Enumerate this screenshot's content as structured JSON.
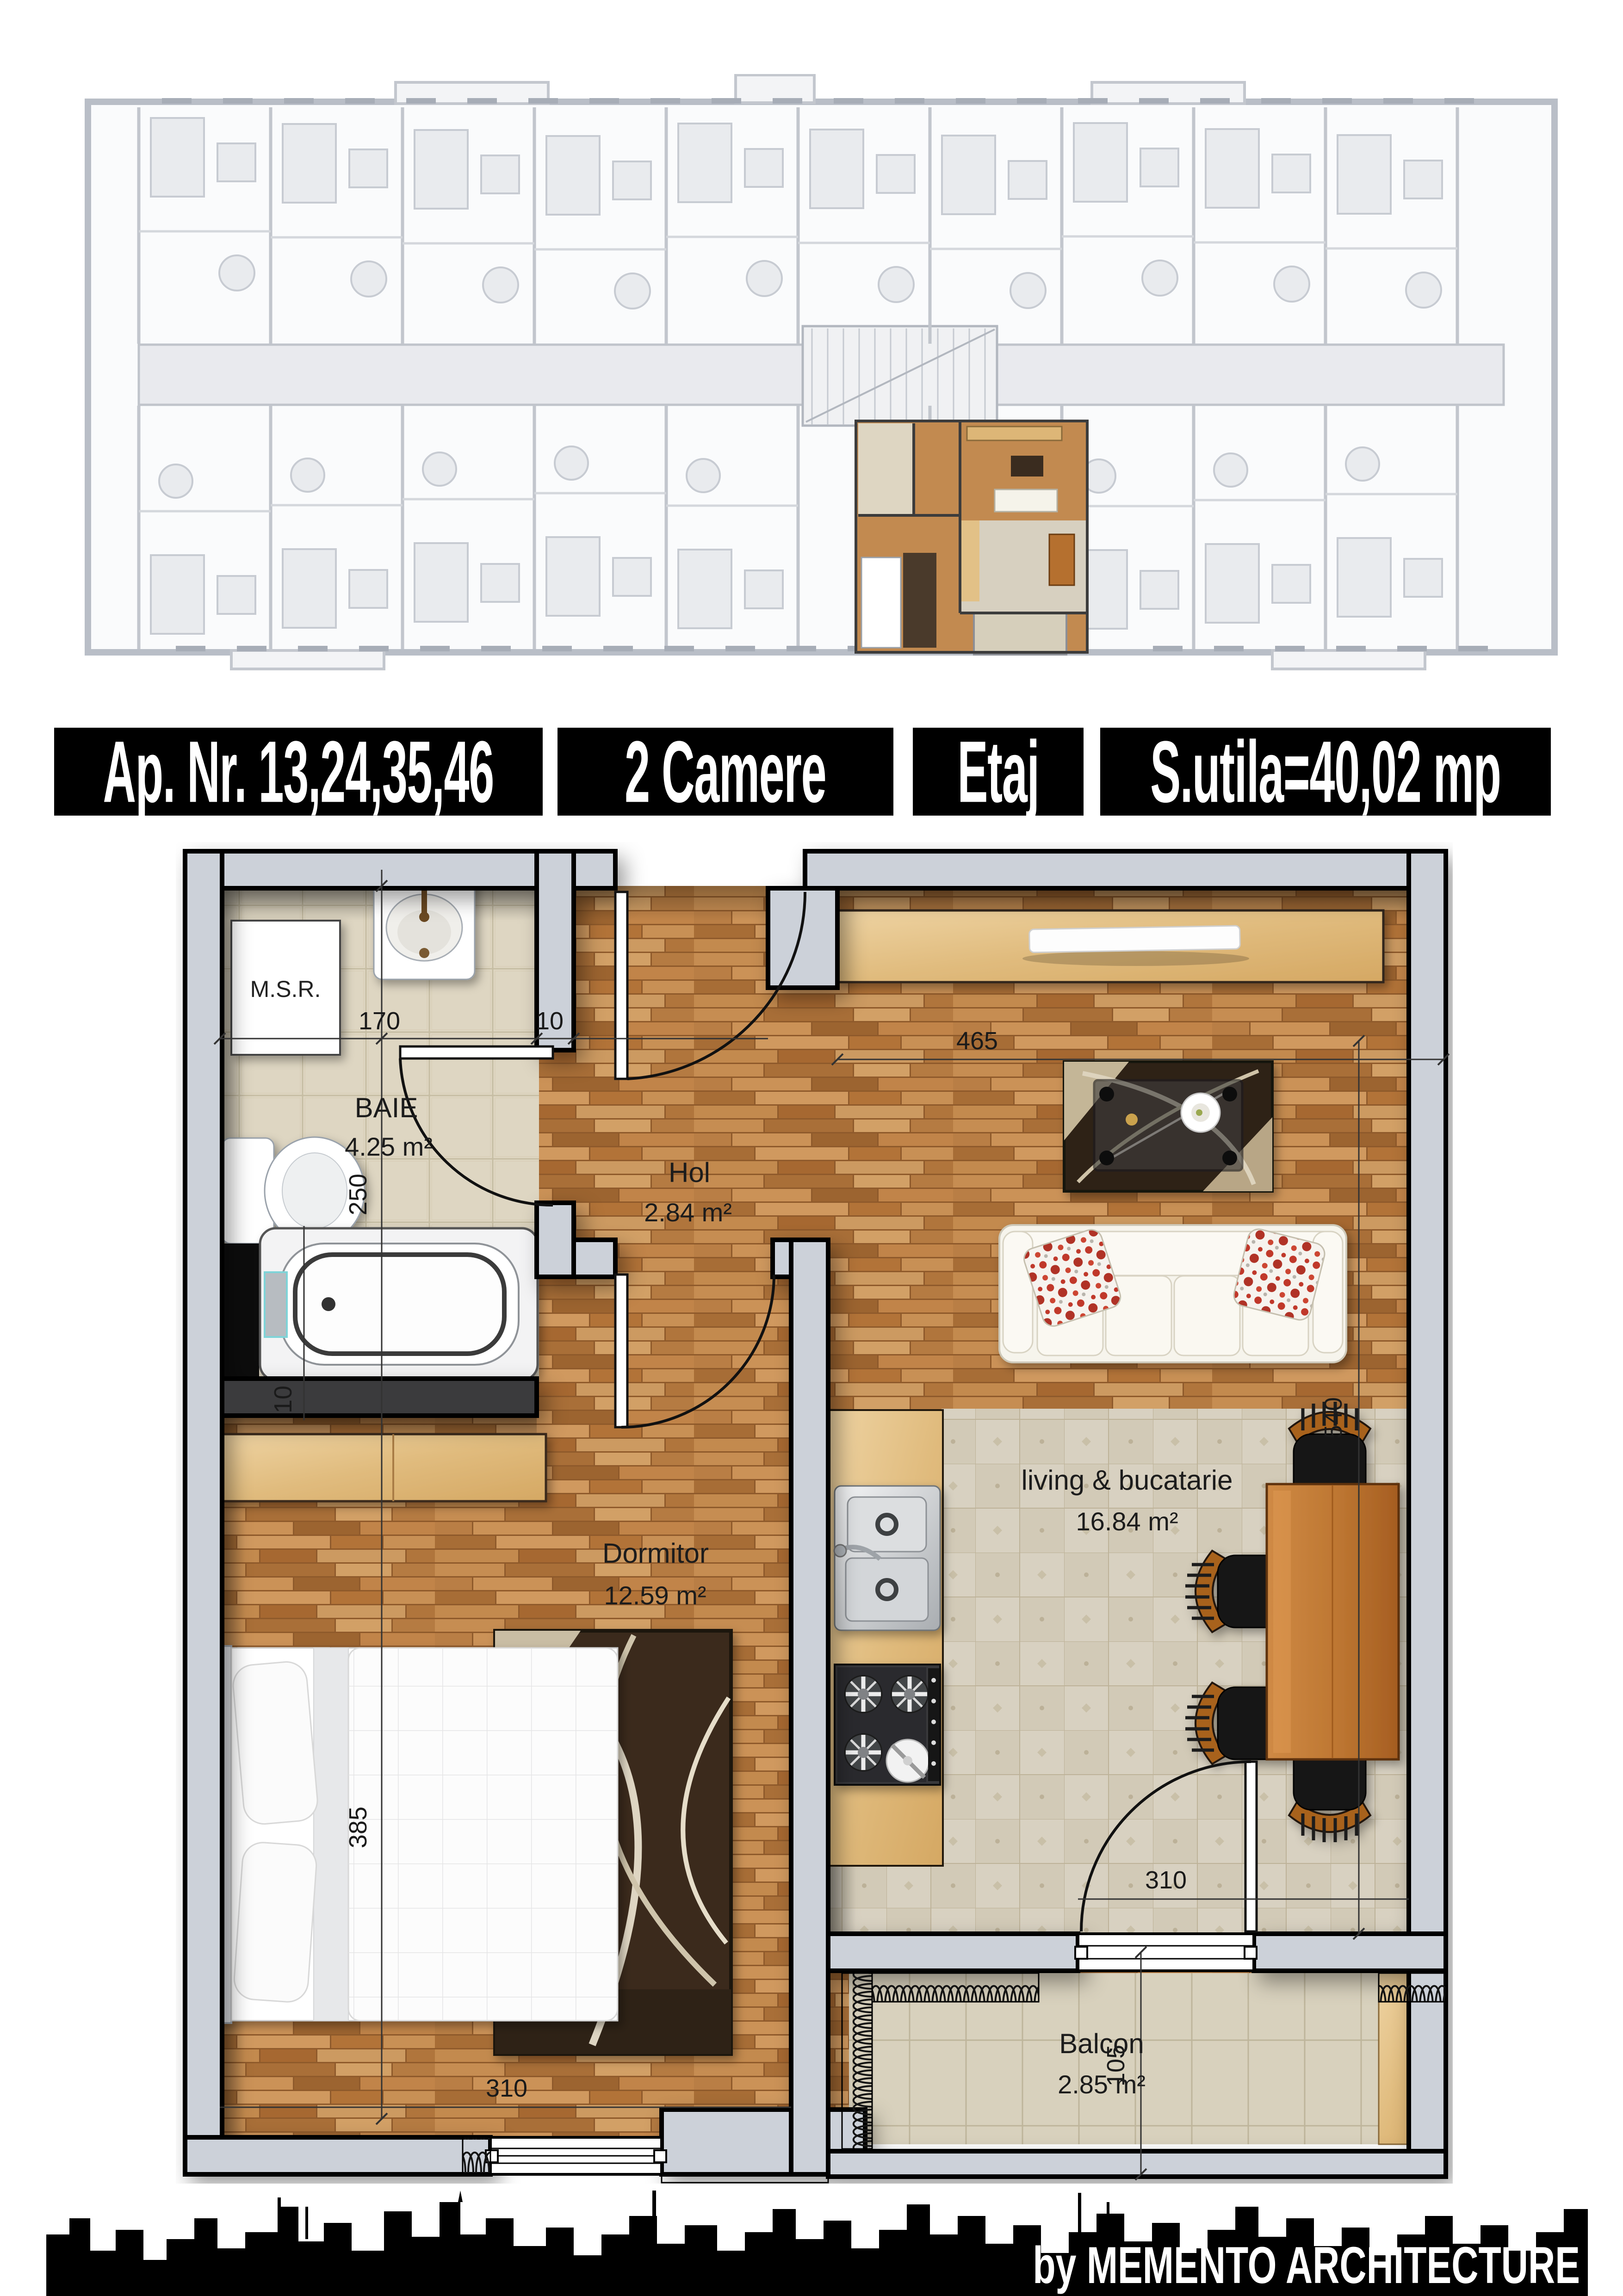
{
  "title_bar": {
    "blocks": [
      {
        "label": "Ap. Nr. 13,24,35,46"
      },
      {
        "label": "2 Camere"
      },
      {
        "label": "Etaj"
      },
      {
        "label": "S.utila=40,02 mp"
      }
    ]
  },
  "plan": {
    "rooms": {
      "baie": {
        "name": "BAIE",
        "area": "4.25 m²"
      },
      "hol": {
        "name": "Hol",
        "area": "2.84 m²"
      },
      "dormitor": {
        "name": "Dormitor",
        "area": "12.59 m²"
      },
      "living": {
        "name": "living & bucatarie",
        "area": "16.84 m²"
      },
      "balcon": {
        "name": "Balcon",
        "area": "2.85 m²"
      }
    },
    "annotations": {
      "msr": "M.S.R."
    },
    "dims": {
      "baie_width": "170",
      "wall_thickness": "10",
      "baie_height": "250",
      "bath_wall": "10",
      "living_width": "465",
      "living_height": "540",
      "dorm_height": "385",
      "dorm_width": "310",
      "balcony_door_width": "310",
      "balcon_height": "105"
    }
  },
  "footer": {
    "credit": "by MEMENTO ARCHITECTURE"
  },
  "colors": {
    "bar_bg": "#000000",
    "bar_fg": "#ffffff",
    "wall": "#ccd1d9",
    "parquet": "#b97b43",
    "tile_bath": "#ded6c2",
    "tile_living": "#d7d0c0",
    "accent_red": "#c0392b",
    "wood_light": "#e0bb7d"
  }
}
